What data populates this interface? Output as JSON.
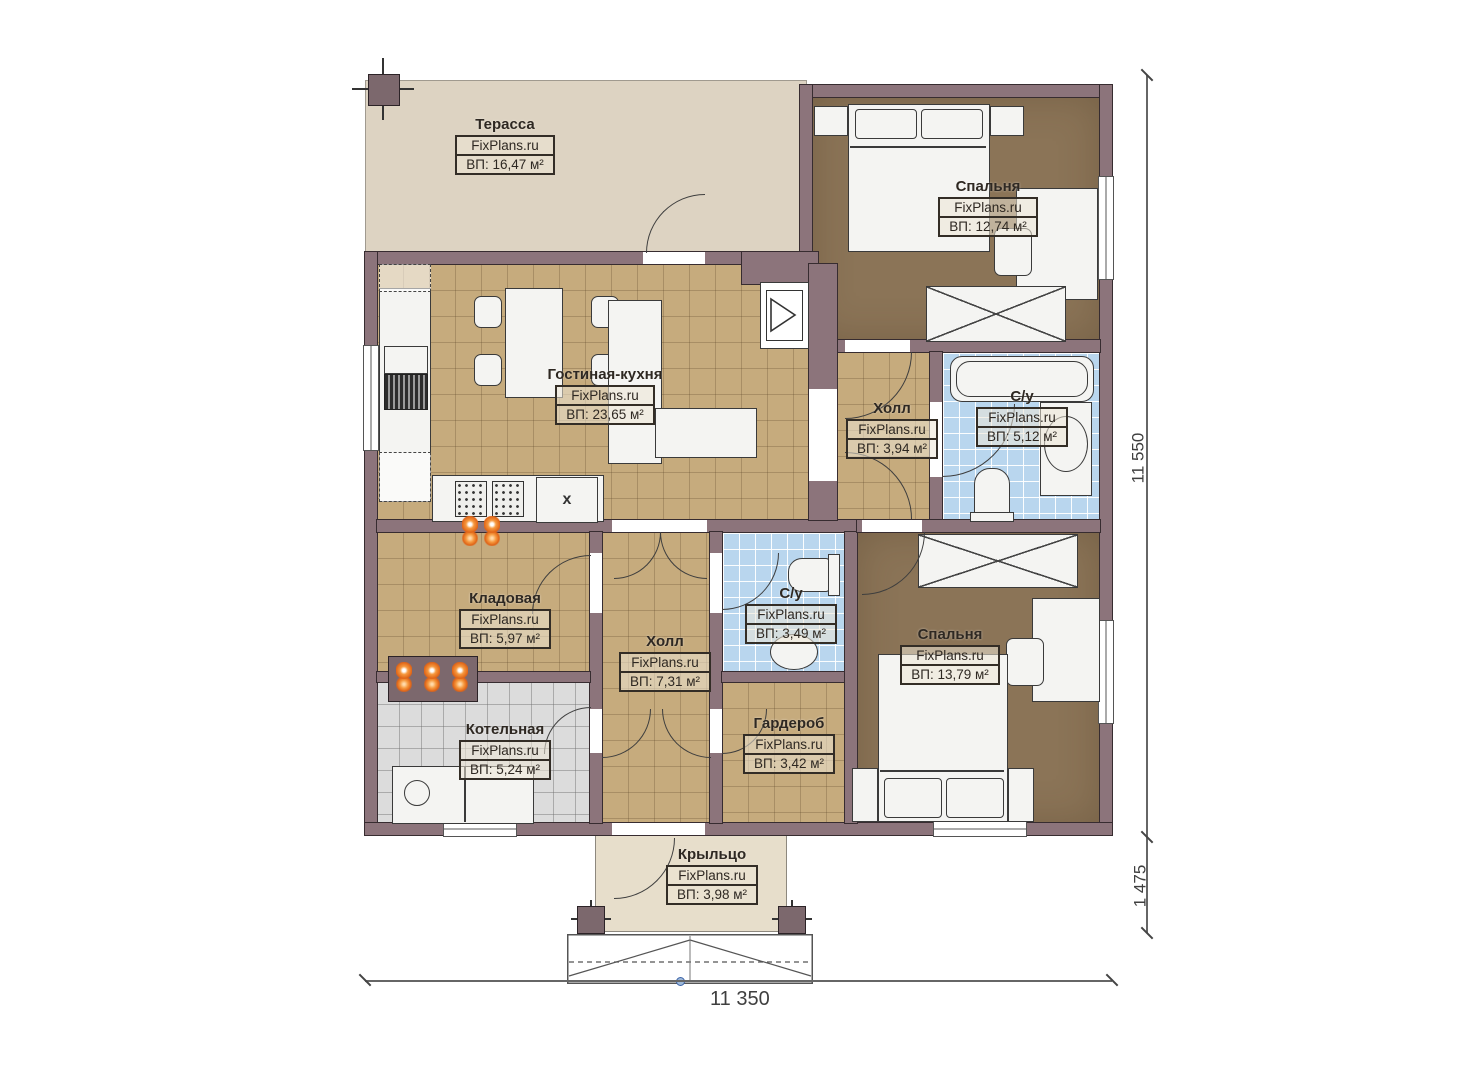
{
  "watermark": "FixPlans.ru",
  "appliance_mark": "x",
  "rooms": [
    {
      "id": "terrace",
      "name": "Терасса",
      "area": "ВП: 16,47 м²"
    },
    {
      "id": "bedroom-top",
      "name": "Спальня",
      "area": "ВП: 12,74 м²"
    },
    {
      "id": "living-kitchen",
      "name": "Гостиная-кухня",
      "area": "ВП: 23,65 м²"
    },
    {
      "id": "hall-upper",
      "name": "Холл",
      "area": "ВП: 3,94 м²"
    },
    {
      "id": "bathroom-upper",
      "name": "С/у",
      "area": "ВП: 5,12 м²"
    },
    {
      "id": "storage",
      "name": "Кладовая",
      "area": "ВП: 5,97 м²"
    },
    {
      "id": "hall-lower",
      "name": "Холл",
      "area": "ВП: 7,31 м²"
    },
    {
      "id": "bathroom-lower",
      "name": "С/у",
      "area": "ВП: 3,49 м²"
    },
    {
      "id": "boiler",
      "name": "Котельная",
      "area": "ВП: 5,24 м²"
    },
    {
      "id": "wardrobe",
      "name": "Гардероб",
      "area": "ВП: 3,42 м²"
    },
    {
      "id": "bedroom-bottom",
      "name": "Спальня",
      "area": "ВП: 13,79 м²"
    },
    {
      "id": "porch",
      "name": "Крыльцо",
      "area": "ВП: 3,98 м²"
    }
  ],
  "dimensions": {
    "right_total": "11 550",
    "right_porch": "1 475",
    "bottom_total": "11 350"
  },
  "colors": {
    "wall": "#8c747b",
    "tile_tan": "#c6ab7d",
    "tile_blue": "#b9d6ee",
    "tile_grey": "#dcdcdc",
    "floor_brown": "#8b7457",
    "terrace": "#ddd3c2",
    "porch": "#e7decb",
    "heater_orange": "#df6417"
  }
}
